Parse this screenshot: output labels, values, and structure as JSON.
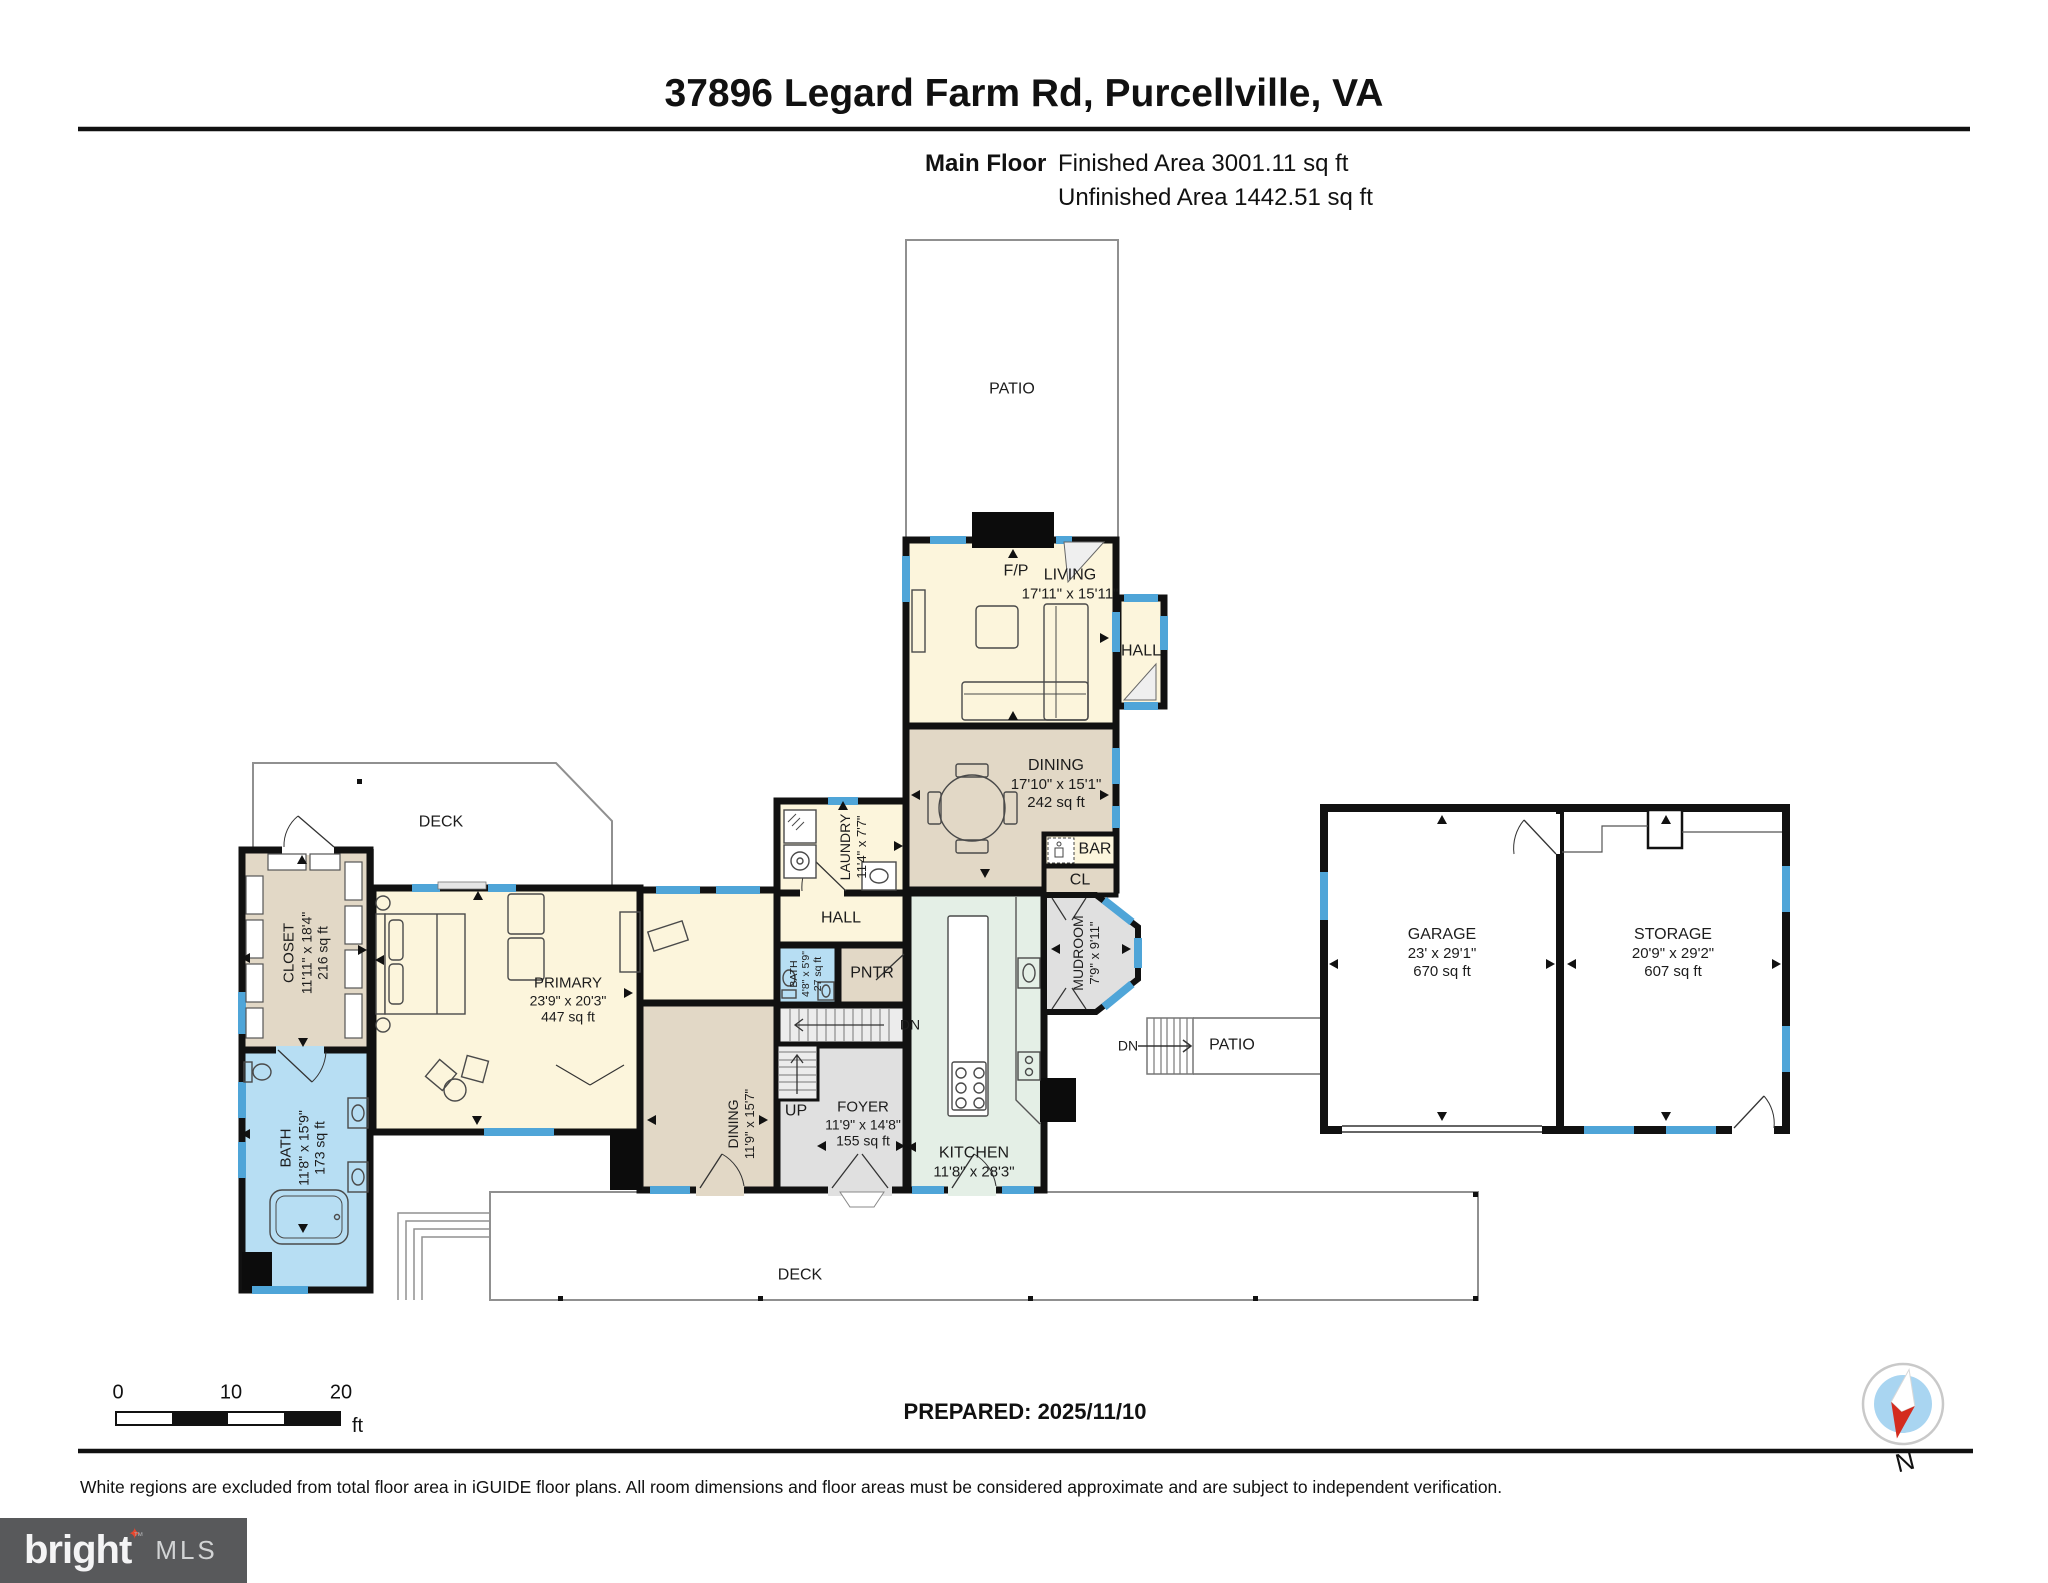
{
  "header": {
    "title": "37896 Legard Farm Rd, Purcellville, VA",
    "floor_label": "Main Floor",
    "finished_area": "Finished Area 3001.11 sq ft",
    "unfinished_area": "Unfinished Area 1442.51 sq ft"
  },
  "plan": {
    "rooms": [
      {
        "name": "PATIO"
      },
      {
        "name": "F/P"
      },
      {
        "name": "LIVING",
        "dims": "17'11\" x 15'11\""
      },
      {
        "name": "HALL"
      },
      {
        "name": "DINING",
        "dims": "17'10\" x 15'1\"",
        "area": "242 sq ft"
      },
      {
        "name": "BAR"
      },
      {
        "name": "CL"
      },
      {
        "name": "MUDROOM",
        "dims": "7'9\" x 9'11\""
      },
      {
        "name": "LAUNDRY",
        "dims": "11'4\" x 7'7\""
      },
      {
        "name": "HALL"
      },
      {
        "name": "BATH",
        "dims": "4'8\" x 5'9\"",
        "area": "27 sq ft"
      },
      {
        "name": "PNTR"
      },
      {
        "name": "DN"
      },
      {
        "name": "UP"
      },
      {
        "name": "FOYER",
        "dims": "11'9\" x 14'8\"",
        "area": "155 sq ft"
      },
      {
        "name": "DINING",
        "dims": "11'9\" x 15'7\""
      },
      {
        "name": "KITCHEN",
        "dims": "11'8\" x 28'3\""
      },
      {
        "name": "DECK"
      },
      {
        "name": "CLOSET",
        "dims": "11'11\" x 18'4\"",
        "area": "216 sq ft"
      },
      {
        "name": "PRIMARY",
        "dims": "23'9\" x 20'3\"",
        "area": "447 sq ft"
      },
      {
        "name": "BATH",
        "dims": "11'8\" x 15'9\"",
        "area": "173 sq ft"
      },
      {
        "name": "DECK"
      },
      {
        "name": "GARAGE",
        "dims": "23' x 29'1\"",
        "area": "670 sq ft"
      },
      {
        "name": "STORAGE",
        "dims": "20'9\" x 29'2\"",
        "area": "607 sq ft"
      },
      {
        "name": "DN"
      },
      {
        "name": "PATIO"
      }
    ]
  },
  "footer": {
    "scale_bar": {
      "tick0": "0",
      "tick1": "10",
      "tick2": "20",
      "unit": "ft"
    },
    "prepared": "PREPARED: 2025/11/10",
    "compass_label": "N",
    "disclaimer": "White regions are excluded from total floor area in iGUIDE floor plans. All room dimensions and floor areas must be considered approximate and are subject to independent verification.",
    "logo": {
      "brand": "bright",
      "trademark": "™",
      "suffix": "MLS",
      "star_glyph": "✦"
    }
  },
  "colors": {
    "wall": "#111111",
    "window": "#4FA5D8",
    "room_cream": "#FCF5DC",
    "room_tan": "#E2D8C6",
    "room_gray": "#E0E0E0",
    "room_blue": "#B7DEF3",
    "room_green": "#E4EFE6",
    "deck_outline": "#909090",
    "compass_north": "#D42B1E",
    "logo_background": "#58595B",
    "logo_star": "#E8462D"
  }
}
